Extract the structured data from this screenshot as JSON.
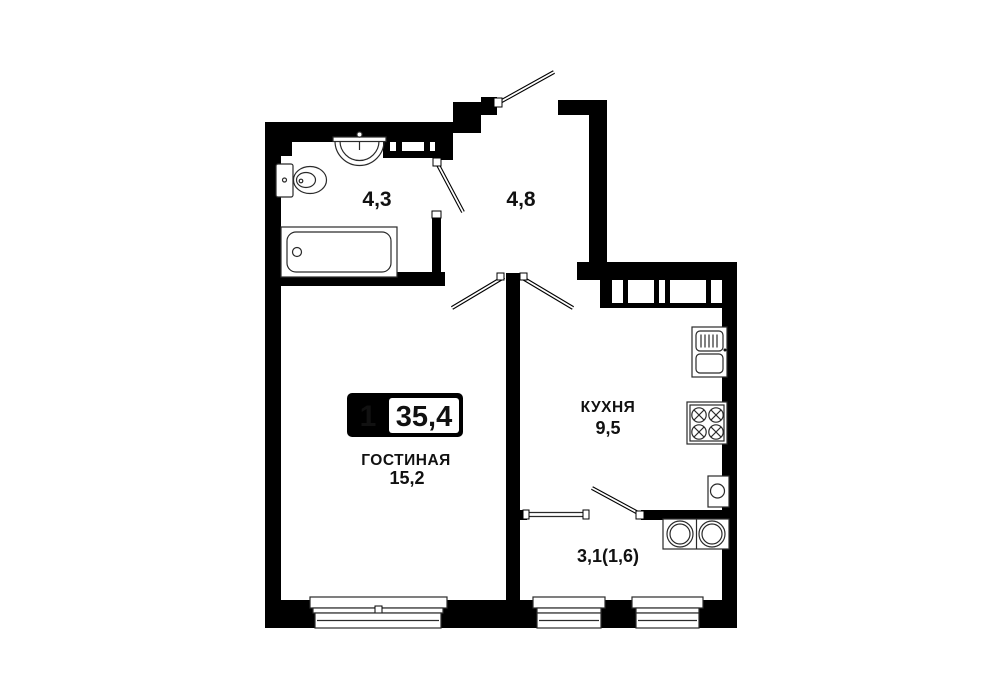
{
  "apartment": {
    "badge": {
      "room_count": "1",
      "total_area": "35,4"
    },
    "labels": {
      "bathroom_area": "4,3",
      "hallway_area": "4,8",
      "kitchen_name": "КУХНЯ",
      "kitchen_area": "9,5",
      "living_name": "ГОСТИНАЯ",
      "living_area": "15,2",
      "balcony_area": "3,1(1,6)"
    },
    "colors": {
      "walls": "#000000",
      "background": "#ffffff",
      "text": "#111111"
    }
  }
}
